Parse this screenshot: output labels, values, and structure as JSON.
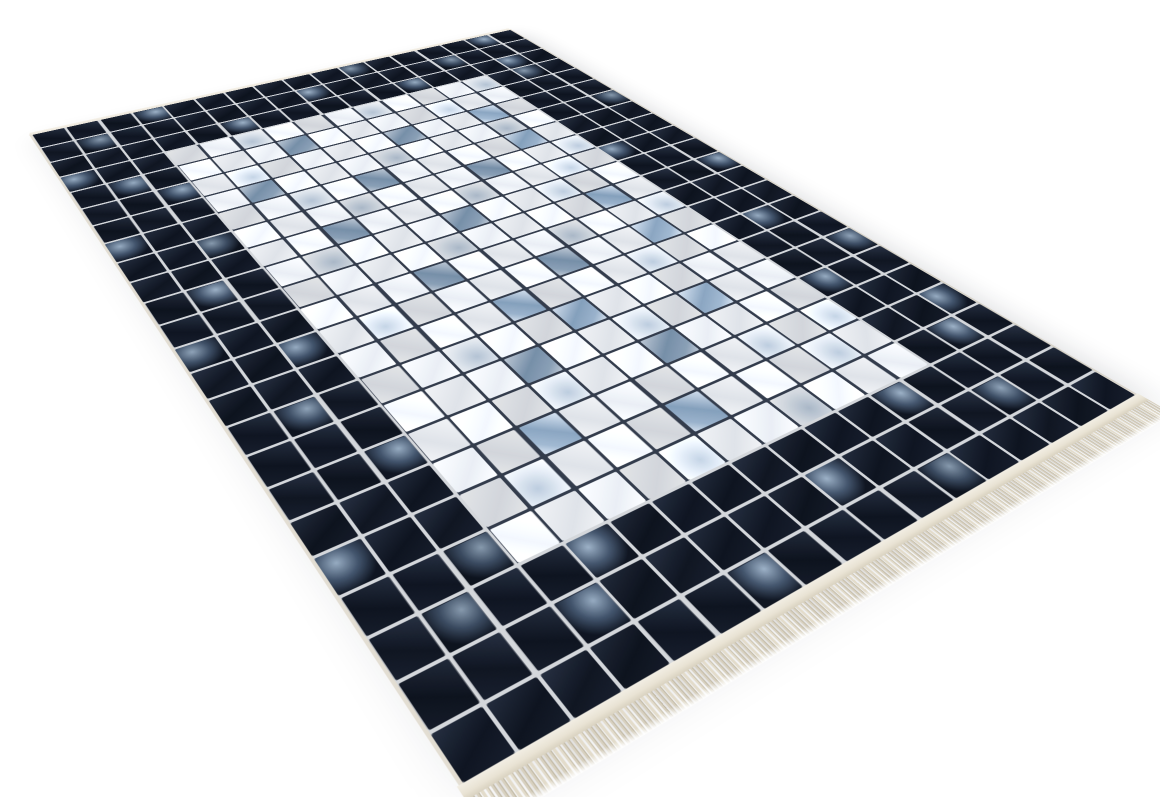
{
  "meta": {
    "type": "product-photo",
    "background": "#ffffff"
  },
  "rug": {
    "description": "Patchwork-pattern area rug in perspective view: dark navy square-tile border, off-white tile field with scattered steel-blue accent tiles, cream selvage on the back edge and cream fringe along the front edge",
    "grid": {
      "cols": 17,
      "rows": 24,
      "border_thickness": 3
    },
    "colors": {
      "bg": "#ffffff",
      "field_hi": "#f1f3f6",
      "field_lo": "#dfe3e9",
      "dark_hi": "#232c3d",
      "dark_lo": "#0e1420",
      "strong_hi": "#c6d2e0",
      "strong_lo": "#7e98b3",
      "soft_hi": "#dde4ec",
      "soft_lo": "#b4c3d4",
      "mottle_hi": "#8fa3b8",
      "mottle_mid": "#3e4f66",
      "grout_field": "#333c4c",
      "grout_border": "#d4d7db",
      "selvage": "#ece6da",
      "binding": "#e9e3d4",
      "fringe": "#e3dccb",
      "fringe_dark": "#c9c1ad",
      "shadow": "rgba(30,36,52,0.14)"
    },
    "accents": {
      "field_strong": [
        [
          4,
          6
        ],
        [
          5,
          9
        ],
        [
          5,
          12
        ],
        [
          6,
          4
        ],
        [
          7,
          7
        ],
        [
          7,
          12
        ],
        [
          8,
          10
        ],
        [
          9,
          5
        ],
        [
          10,
          8
        ],
        [
          11,
          12
        ],
        [
          12,
          6
        ],
        [
          13,
          9
        ],
        [
          13,
          12
        ],
        [
          14,
          7
        ],
        [
          15,
          8
        ],
        [
          16,
          6
        ],
        [
          16,
          11
        ],
        [
          17,
          9
        ],
        [
          18,
          5
        ],
        [
          19,
          8
        ]
      ],
      "field_soft": [
        [
          3,
          5
        ],
        [
          3,
          9
        ],
        [
          3,
          13
        ],
        [
          4,
          11
        ],
        [
          5,
          4
        ],
        [
          6,
          8
        ],
        [
          6,
          12
        ],
        [
          7,
          5
        ],
        [
          8,
          6
        ],
        [
          8,
          13
        ],
        [
          9,
          9
        ],
        [
          9,
          12
        ],
        [
          10,
          4
        ],
        [
          10,
          11
        ],
        [
          11,
          7
        ],
        [
          12,
          10
        ],
        [
          12,
          13
        ],
        [
          13,
          4
        ],
        [
          14,
          11
        ],
        [
          15,
          5
        ],
        [
          16,
          9
        ],
        [
          17,
          6
        ],
        [
          18,
          11
        ],
        [
          18,
          13
        ],
        [
          19,
          4
        ],
        [
          19,
          12
        ],
        [
          20,
          7
        ],
        [
          20,
          10
        ]
      ],
      "border_mottled": [
        [
          0,
          3
        ],
        [
          1,
          1
        ],
        [
          1,
          8
        ],
        [
          0,
          10
        ],
        [
          1,
          13
        ],
        [
          2,
          5
        ],
        [
          2,
          11
        ],
        [
          0,
          15
        ],
        [
          2,
          15
        ],
        [
          3,
          0
        ],
        [
          4,
          1
        ],
        [
          5,
          2
        ],
        [
          7,
          0
        ],
        [
          8,
          2
        ],
        [
          10,
          1
        ],
        [
          12,
          0
        ],
        [
          13,
          2
        ],
        [
          15,
          1
        ],
        [
          17,
          2
        ],
        [
          19,
          0
        ],
        [
          20,
          2
        ],
        [
          21,
          1
        ],
        [
          3,
          15
        ],
        [
          6,
          16
        ],
        [
          9,
          14
        ],
        [
          11,
          16
        ],
        [
          14,
          15
        ],
        [
          16,
          16
        ],
        [
          17,
          14
        ],
        [
          19,
          16
        ],
        [
          20,
          15
        ],
        [
          21,
          4
        ],
        [
          21,
          12
        ],
        [
          22,
          3
        ],
        [
          22,
          9
        ],
        [
          22,
          14
        ],
        [
          23,
          6
        ],
        [
          23,
          11
        ]
      ]
    }
  }
}
